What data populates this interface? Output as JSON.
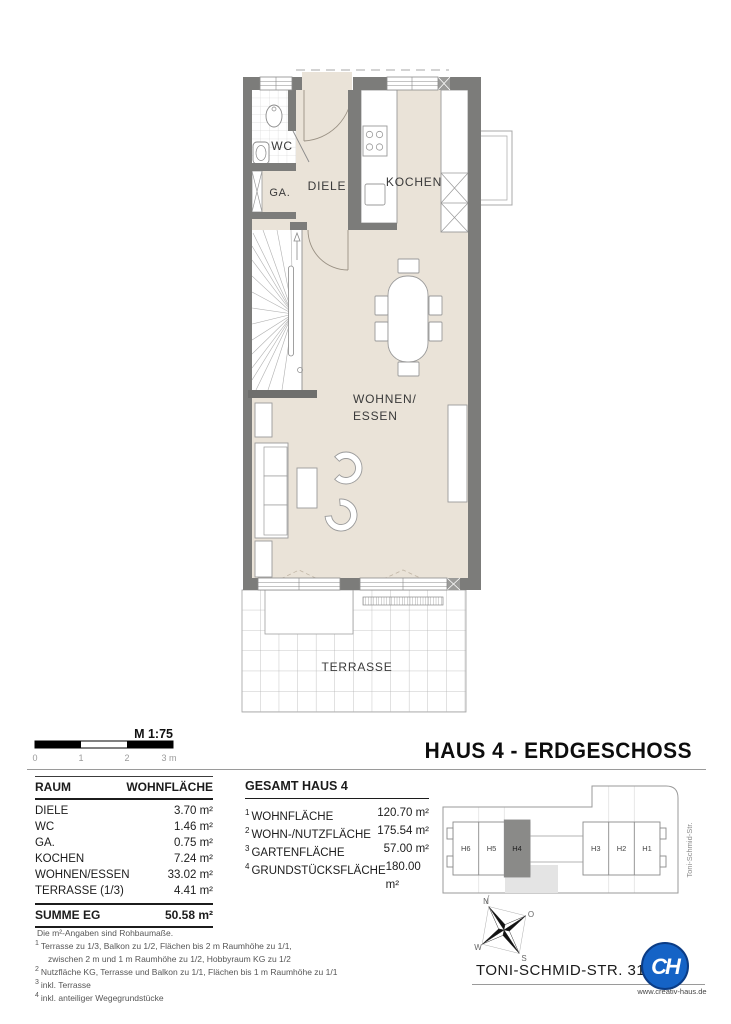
{
  "header": {
    "title": "HAUS 4 - ERDGESCHOSS"
  },
  "scalebar": {
    "label": "M 1:75",
    "ticks": [
      "0",
      "1",
      "2",
      "3 m"
    ]
  },
  "plan_labels": {
    "wc": "WC",
    "ga": "GA.",
    "diele": "DIELE",
    "kochen": "KOCHEN",
    "wohnen_line1": "WOHNEN/",
    "wohnen_line2": "ESSEN",
    "terrasse": "TERRASSE"
  },
  "area_table": {
    "col_room": "RAUM",
    "col_area": "WOHNFLÄCHE",
    "rows": [
      {
        "room": "DIELE",
        "area": "3.70 m²"
      },
      {
        "room": "WC",
        "area": "1.46 m²"
      },
      {
        "room": "GA.",
        "area": "0.75 m²"
      },
      {
        "room": "KOCHEN",
        "area": "7.24 m²"
      },
      {
        "room": "WOHNEN/ESSEN",
        "area": "33.02 m²"
      },
      {
        "room": "TERRASSE (1/3)",
        "area": "4.41 m²"
      }
    ],
    "total_label": "SUMME EG",
    "total_value": "50.58 m²"
  },
  "totals": {
    "title": "GESAMT HAUS 4",
    "rows": [
      {
        "sup": "1",
        "label": "WOHNFLÄCHE",
        "value": "120.70 m²"
      },
      {
        "sup": "2",
        "label": "WOHN-/NUTZFLÄCHE",
        "value": "175.54 m²"
      },
      {
        "sup": "3",
        "label": "GARTENFLÄCHE",
        "value": "57.00 m²"
      },
      {
        "sup": "4",
        "label": "GRUNDSTÜCKSFLÄCHE",
        "value": "180.00 m²"
      }
    ]
  },
  "site_plan": {
    "houses": [
      "H6",
      "H5",
      "H4",
      "H3",
      "H2",
      "H1"
    ],
    "street": "Toni-Schmid-Str.",
    "address": "TONI-SCHMID-STR. 31"
  },
  "compass": {
    "n": "N",
    "e": "O",
    "s": "S",
    "w": "W"
  },
  "footnotes": [
    {
      "sup": "",
      "text": "Die m²-Angaben sind Rohbaumaße.",
      "indent": false
    },
    {
      "sup": "1",
      "text": "Terrasse  zu 1/3, Balkon zu 1/2, Flächen bis 2 m Raumhöhe zu 1/1,",
      "indent": false
    },
    {
      "sup": "",
      "text": "zwischen 2 m und 1 m Raumhöhe zu 1/2, Hobbyraum KG zu 1/2",
      "indent": true
    },
    {
      "sup": "2",
      "text": "Nutzfläche KG, Terrasse und Balkon zu 1/1, Flächen bis 1 m Raumhöhe zu 1/1",
      "indent": false
    },
    {
      "sup": "3",
      "text": "inkl. Terrasse",
      "indent": false
    },
    {
      "sup": "4",
      "text": "inkl. anteiliger Wegegrundstücke",
      "indent": false
    }
  ],
  "logo": {
    "monogram": "CH",
    "url": "www.creativ-haus.de"
  },
  "colors": {
    "floor": "#EAE3D8",
    "wall": "#7C7C7A",
    "accent_blue": "#1563C6",
    "site_highlight": "#8A8A88"
  }
}
